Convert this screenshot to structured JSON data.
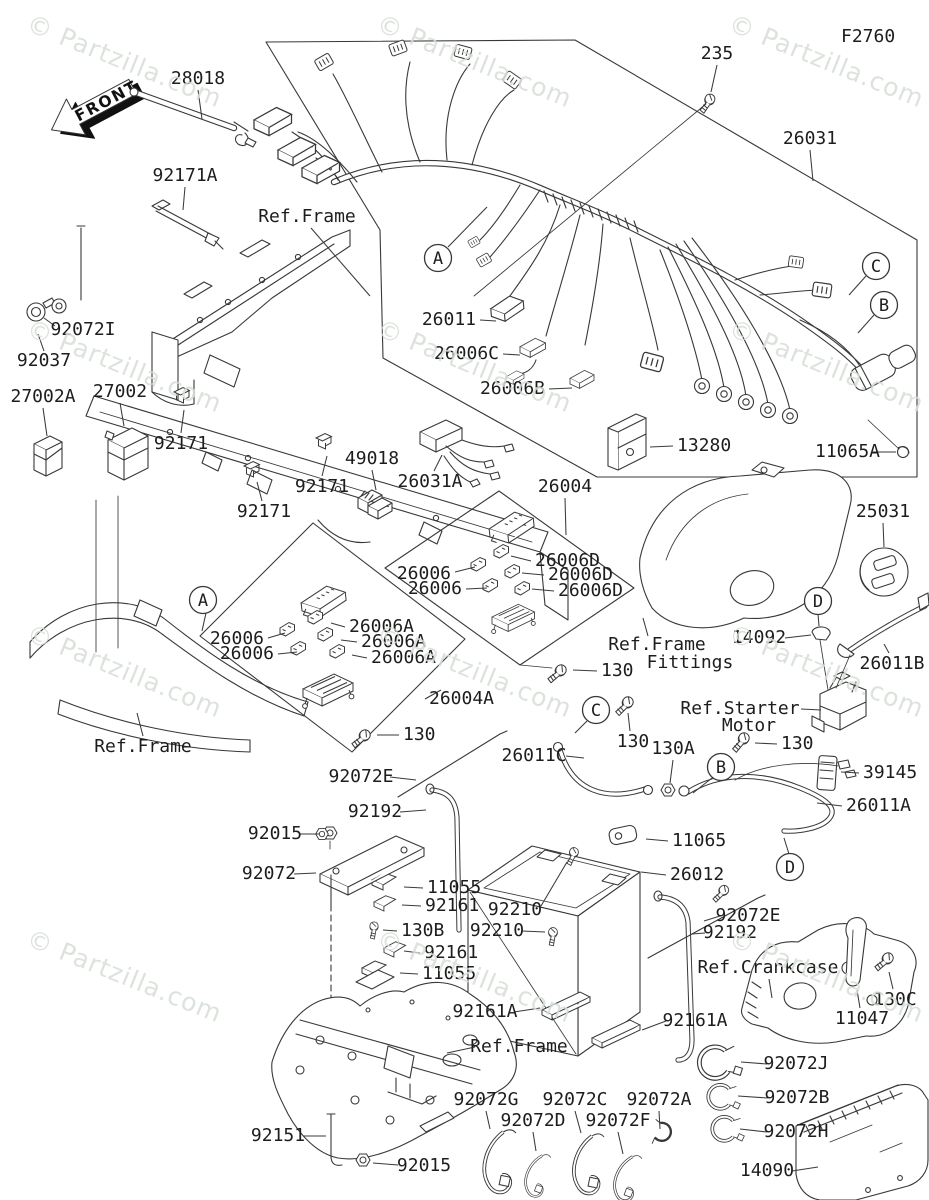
{
  "figure": {
    "code": "F2760",
    "front_arrow_label": "FRONT",
    "watermark": {
      "text": "© Partzilla.com",
      "color": "#d6ddd6",
      "rotation_deg": 22,
      "positions": [
        [
          25,
          30
        ],
        [
          375,
          30
        ],
        [
          727,
          30
        ],
        [
          25,
          335
        ],
        [
          375,
          335
        ],
        [
          727,
          335
        ],
        [
          25,
          640
        ],
        [
          375,
          640
        ],
        [
          727,
          640
        ],
        [
          25,
          945
        ],
        [
          375,
          945
        ],
        [
          727,
          945
        ]
      ]
    },
    "colors": {
      "line": "#383838",
      "text": "#1d1d1d",
      "background": "#ffffff"
    },
    "callouts": [
      {
        "letter": "A",
        "x": 438,
        "y": 258,
        "l": [
          448,
          247,
          487,
          207
        ]
      },
      {
        "letter": "A",
        "x": 203,
        "y": 600,
        "l": [
          206,
          613,
          202,
          631
        ]
      },
      {
        "letter": "C",
        "x": 876,
        "y": 266,
        "l": [
          866,
          276,
          849,
          295
        ]
      },
      {
        "letter": "B",
        "x": 884,
        "y": 305,
        "l": [
          874,
          315,
          858,
          333
        ]
      },
      {
        "letter": "C",
        "x": 596,
        "y": 710,
        "l": [
          587,
          721,
          575,
          733
        ]
      },
      {
        "letter": "B",
        "x": 721,
        "y": 767,
        "l": [
          712,
          778,
          693,
          793
        ]
      },
      {
        "letter": "D",
        "x": 818,
        "y": 601,
        "l": [
          818,
          614,
          819,
          626
        ]
      },
      {
        "letter": "D",
        "x": 790,
        "y": 867,
        "l": [
          789,
          854,
          784,
          838
        ]
      }
    ],
    "labels": [
      {
        "t": "F2760",
        "x": 841,
        "y": 37,
        "a": "s",
        "s": 20
      },
      {
        "t": "235",
        "x": 717,
        "y": 54,
        "a": "m",
        "l": [
          717,
          65,
          711,
          92
        ]
      },
      {
        "t": "26031",
        "x": 810,
        "y": 139,
        "a": "m",
        "l": [
          810,
          150,
          813,
          181
        ]
      },
      {
        "t": "28018",
        "x": 198,
        "y": 79,
        "a": "m",
        "l": [
          198,
          90,
          202,
          119
        ]
      },
      {
        "t": "92171A",
        "x": 185,
        "y": 176,
        "a": "m",
        "l": [
          185,
          187,
          183,
          210
        ]
      },
      {
        "t": "Ref.Frame",
        "x": 307,
        "y": 217,
        "a": "m",
        "l": [
          311,
          228,
          370,
          296
        ]
      },
      {
        "t": "92072I",
        "x": 83,
        "y": 330,
        "a": "m",
        "l": [
          55,
          326,
          44,
          318
        ]
      },
      {
        "t": "92037",
        "x": 44,
        "y": 361,
        "a": "m",
        "l": [
          44,
          351,
          38,
          334
        ]
      },
      {
        "t": "27002A",
        "x": 43,
        "y": 397,
        "a": "m",
        "l": [
          43,
          408,
          47,
          436
        ]
      },
      {
        "t": "27002",
        "x": 120,
        "y": 392,
        "a": "m",
        "l": [
          120,
          403,
          124,
          426
        ]
      },
      {
        "t": "92171",
        "x": 181,
        "y": 444,
        "a": "m",
        "l": [
          181,
          433,
          184,
          410
        ]
      },
      {
        "t": "92171",
        "x": 322,
        "y": 487,
        "a": "m",
        "l": [
          322,
          476,
          327,
          456
        ]
      },
      {
        "t": "92171",
        "x": 264,
        "y": 512,
        "a": "m",
        "l": [
          262,
          501,
          257,
          482
        ]
      },
      {
        "t": "49018",
        "x": 372,
        "y": 459,
        "a": "m",
        "l": [
          372,
          470,
          376,
          490
        ]
      },
      {
        "t": "26031A",
        "x": 430,
        "y": 482,
        "a": "m",
        "l": [
          434,
          471,
          442,
          455
        ]
      },
      {
        "t": "26011",
        "x": 476,
        "y": 320,
        "a": "e",
        "l": [
          480,
          320,
          496,
          321
        ]
      },
      {
        "t": "26006C",
        "x": 499,
        "y": 354,
        "a": "e",
        "l": [
          503,
          354,
          520,
          355
        ]
      },
      {
        "t": "26006B",
        "x": 545,
        "y": 389,
        "a": "e",
        "l": [
          549,
          389,
          572,
          388
        ]
      },
      {
        "t": "13280",
        "x": 677,
        "y": 446,
        "a": "s",
        "l": [
          673,
          446,
          650,
          447
        ]
      },
      {
        "t": "11065A",
        "x": 815,
        "y": 452,
        "a": "s",
        "l": [
          873,
          452,
          896,
          452
        ]
      },
      {
        "t": "26004",
        "x": 565,
        "y": 487,
        "a": "m",
        "l": [
          565,
          498,
          566,
          535
        ]
      },
      {
        "t": "25031",
        "x": 883,
        "y": 512,
        "a": "m",
        "l": [
          883,
          523,
          884,
          547
        ]
      },
      {
        "t": "26006D",
        "x": 535,
        "y": 561,
        "a": "s",
        "l": [
          531,
          561,
          511,
          556
        ]
      },
      {
        "t": "26006D",
        "x": 548,
        "y": 575,
        "a": "s",
        "l": [
          544,
          575,
          522,
          573
        ]
      },
      {
        "t": "26006D",
        "x": 558,
        "y": 591,
        "a": "s",
        "l": [
          554,
          591,
          532,
          589
        ]
      },
      {
        "t": "26006",
        "x": 451,
        "y": 574,
        "a": "e",
        "l": [
          455,
          572,
          475,
          567
        ]
      },
      {
        "t": "26006",
        "x": 462,
        "y": 589,
        "a": "e",
        "l": [
          466,
          589,
          487,
          588
        ]
      },
      {
        "t": "26006A",
        "x": 349,
        "y": 627,
        "a": "s",
        "l": [
          345,
          627,
          331,
          623
        ]
      },
      {
        "t": "26006A",
        "x": 361,
        "y": 642,
        "a": "s",
        "l": [
          357,
          642,
          341,
          640
        ]
      },
      {
        "t": "26006A",
        "x": 371,
        "y": 658,
        "a": "s",
        "l": [
          367,
          658,
          352,
          655
        ]
      },
      {
        "t": "26006",
        "x": 264,
        "y": 639,
        "a": "e",
        "l": [
          268,
          638,
          285,
          633
        ]
      },
      {
        "t": "26006",
        "x": 274,
        "y": 654,
        "a": "e",
        "l": [
          278,
          654,
          297,
          652
        ]
      },
      {
        "t": "26004A",
        "x": 429,
        "y": 699,
        "a": "s",
        "l": [
          425,
          699,
          441,
          690
        ]
      },
      {
        "t": "130",
        "x": 403,
        "y": 735,
        "a": "s",
        "l": [
          399,
          735,
          377,
          735
        ]
      },
      {
        "t": "Ref.Frame",
        "x": 143,
        "y": 747,
        "a": "m",
        "l": [
          143,
          736,
          137,
          713
        ]
      },
      {
        "t": "Ref.Frame",
        "x": 657,
        "y": 645,
        "a": "m",
        "l": [
          648,
          636,
          643,
          618
        ]
      },
      {
        "t": "Fittings",
        "x": 690,
        "y": 663,
        "a": "m"
      },
      {
        "t": "14092",
        "x": 759,
        "y": 638,
        "a": "m",
        "l": [
          785,
          638,
          811,
          635
        ]
      },
      {
        "t": "26011B",
        "x": 892,
        "y": 664,
        "a": "m",
        "l": [
          889,
          653,
          884,
          644
        ]
      },
      {
        "t": "130",
        "x": 601,
        "y": 671,
        "a": "s",
        "l": [
          597,
          671,
          573,
          670
        ]
      },
      {
        "t": "Ref.Starter",
        "x": 740,
        "y": 709,
        "a": "m",
        "l": [
          801,
          709,
          821,
          710
        ]
      },
      {
        "t": "Motor",
        "x": 749,
        "y": 726,
        "a": "m"
      },
      {
        "t": "26011C",
        "x": 534,
        "y": 756,
        "a": "m",
        "l": [
          566,
          756,
          584,
          758
        ]
      },
      {
        "t": "130",
        "x": 633,
        "y": 742,
        "a": "m",
        "l": [
          630,
          731,
          628,
          713
        ]
      },
      {
        "t": "130A",
        "x": 673,
        "y": 749,
        "a": "m",
        "l": [
          673,
          760,
          670,
          783
        ]
      },
      {
        "t": "130",
        "x": 781,
        "y": 744,
        "a": "s",
        "l": [
          777,
          744,
          755,
          743
        ]
      },
      {
        "t": "39145",
        "x": 863,
        "y": 773,
        "a": "s",
        "l": [
          859,
          773,
          841,
          772
        ]
      },
      {
        "t": "26011A",
        "x": 846,
        "y": 806,
        "a": "s",
        "l": [
          842,
          806,
          817,
          803
        ]
      },
      {
        "t": "92072E",
        "x": 361,
        "y": 777,
        "a": "m",
        "l": [
          390,
          777,
          416,
          780
        ]
      },
      {
        "t": "92192",
        "x": 375,
        "y": 812,
        "a": "m",
        "l": [
          400,
          812,
          426,
          810
        ]
      },
      {
        "t": "92015",
        "x": 275,
        "y": 834,
        "a": "m",
        "l": [
          300,
          834,
          319,
          834
        ]
      },
      {
        "t": "92072",
        "x": 269,
        "y": 874,
        "a": "m",
        "l": [
          294,
          874,
          316,
          873
        ]
      },
      {
        "t": "11055",
        "x": 427,
        "y": 888,
        "a": "s",
        "l": [
          423,
          888,
          404,
          887
        ]
      },
      {
        "t": "92161",
        "x": 425,
        "y": 906,
        "a": "s",
        "l": [
          421,
          906,
          402,
          905
        ]
      },
      {
        "t": "130B",
        "x": 401,
        "y": 931,
        "a": "s",
        "l": [
          397,
          931,
          383,
          930
        ]
      },
      {
        "t": "92161",
        "x": 424,
        "y": 953,
        "a": "s",
        "l": [
          420,
          953,
          404,
          951
        ]
      },
      {
        "t": "11055",
        "x": 422,
        "y": 974,
        "a": "s",
        "l": [
          418,
          974,
          400,
          973
        ]
      },
      {
        "t": "11065",
        "x": 672,
        "y": 841,
        "a": "s",
        "l": [
          668,
          841,
          646,
          839
        ]
      },
      {
        "t": "26012",
        "x": 670,
        "y": 875,
        "a": "s",
        "l": [
          666,
          875,
          641,
          872
        ]
      },
      {
        "t": "92210",
        "x": 515,
        "y": 910,
        "a": "m",
        "l": [
          541,
          906,
          567,
          862
        ]
      },
      {
        "t": "92210",
        "x": 497,
        "y": 931,
        "a": "m",
        "l": [
          522,
          931,
          545,
          932
        ]
      },
      {
        "t": "92072E",
        "x": 748,
        "y": 916,
        "a": "m",
        "l": [
          720,
          916,
          704,
          921
        ]
      },
      {
        "t": "92192",
        "x": 730,
        "y": 933,
        "a": "m",
        "l": [
          705,
          933,
          692,
          934
        ]
      },
      {
        "t": "Ref.Crankcase",
        "x": 768,
        "y": 968,
        "a": "m",
        "l": [
          769,
          979,
          772,
          998
        ]
      },
      {
        "t": "130C",
        "x": 895,
        "y": 1000,
        "a": "m",
        "l": [
          893,
          989,
          889,
          972
        ]
      },
      {
        "t": "11047",
        "x": 862,
        "y": 1019,
        "a": "m",
        "l": [
          860,
          1008,
          857,
          990
        ]
      },
      {
        "t": "92161A",
        "x": 485,
        "y": 1012,
        "a": "m",
        "l": [
          514,
          1012,
          540,
          1008
        ]
      },
      {
        "t": "92161A",
        "x": 695,
        "y": 1021,
        "a": "m",
        "l": [
          666,
          1021,
          642,
          1030
        ]
      },
      {
        "t": "Ref.Frame",
        "x": 519,
        "y": 1047,
        "a": "m",
        "l": [
          475,
          1047,
          447,
          1053
        ]
      },
      {
        "t": "92072J",
        "x": 796,
        "y": 1064,
        "a": "m",
        "l": [
          767,
          1064,
          741,
          1062
        ]
      },
      {
        "t": "92072B",
        "x": 797,
        "y": 1098,
        "a": "m",
        "l": [
          768,
          1098,
          738,
          1096
        ]
      },
      {
        "t": "92072H",
        "x": 796,
        "y": 1132,
        "a": "m",
        "l": [
          767,
          1132,
          740,
          1129
        ]
      },
      {
        "t": "92072G",
        "x": 486,
        "y": 1100,
        "a": "m",
        "l": [
          486,
          1111,
          490,
          1129
        ]
      },
      {
        "t": "92072C",
        "x": 575,
        "y": 1100,
        "a": "m",
        "l": [
          575,
          1111,
          581,
          1133
        ]
      },
      {
        "t": "92072A",
        "x": 659,
        "y": 1100,
        "a": "m",
        "l": [
          659,
          1111,
          660,
          1129
        ]
      },
      {
        "t": "92072D",
        "x": 533,
        "y": 1121,
        "a": "m",
        "l": [
          533,
          1132,
          536,
          1151
        ]
      },
      {
        "t": "92072F",
        "x": 618,
        "y": 1121,
        "a": "m",
        "l": [
          618,
          1132,
          623,
          1154
        ]
      },
      {
        "t": "92151",
        "x": 278,
        "y": 1136,
        "a": "m",
        "l": [
          303,
          1136,
          326,
          1136
        ]
      },
      {
        "t": "92015",
        "x": 424,
        "y": 1166,
        "a": "m",
        "l": [
          398,
          1165,
          373,
          1163
        ]
      },
      {
        "t": "14090",
        "x": 767,
        "y": 1171,
        "a": "m",
        "l": [
          792,
          1171,
          818,
          1167
        ]
      }
    ]
  }
}
